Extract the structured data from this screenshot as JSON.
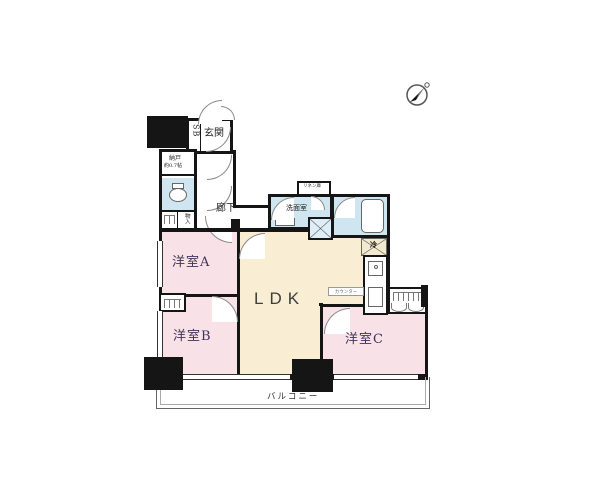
{
  "floor_plan": {
    "compass": {
      "icon": "north-arrow",
      "pointing": "upper-right"
    },
    "rooms": {
      "entrance": {
        "label": "玄関"
      },
      "shoe_box": {
        "label": "SB"
      },
      "storage_room": {
        "label": "納戸",
        "size": "約0.7帖"
      },
      "corridor": {
        "label": "廊下"
      },
      "linen_closet": {
        "label": "リネン庫"
      },
      "washroom": {
        "label": "洗面室"
      },
      "refrigerator_space": {
        "label": "冷"
      },
      "closet": {
        "label": "物入"
      },
      "counter": {
        "label": "カウンター"
      },
      "ldk": {
        "label": "LDK"
      },
      "western_room_a": {
        "label": "洋室A"
      },
      "western_room_b": {
        "label": "洋室B"
      },
      "western_room_c": {
        "label": "洋室C"
      },
      "balcony": {
        "label": "バルコニー"
      }
    },
    "colors": {
      "bedroom_pink": "#f8e2e7",
      "ldk_cream": "#f9eed3",
      "wet_area_blue": "#cfe6f1",
      "wall_black": "#151515",
      "background": "#ffffff"
    }
  }
}
